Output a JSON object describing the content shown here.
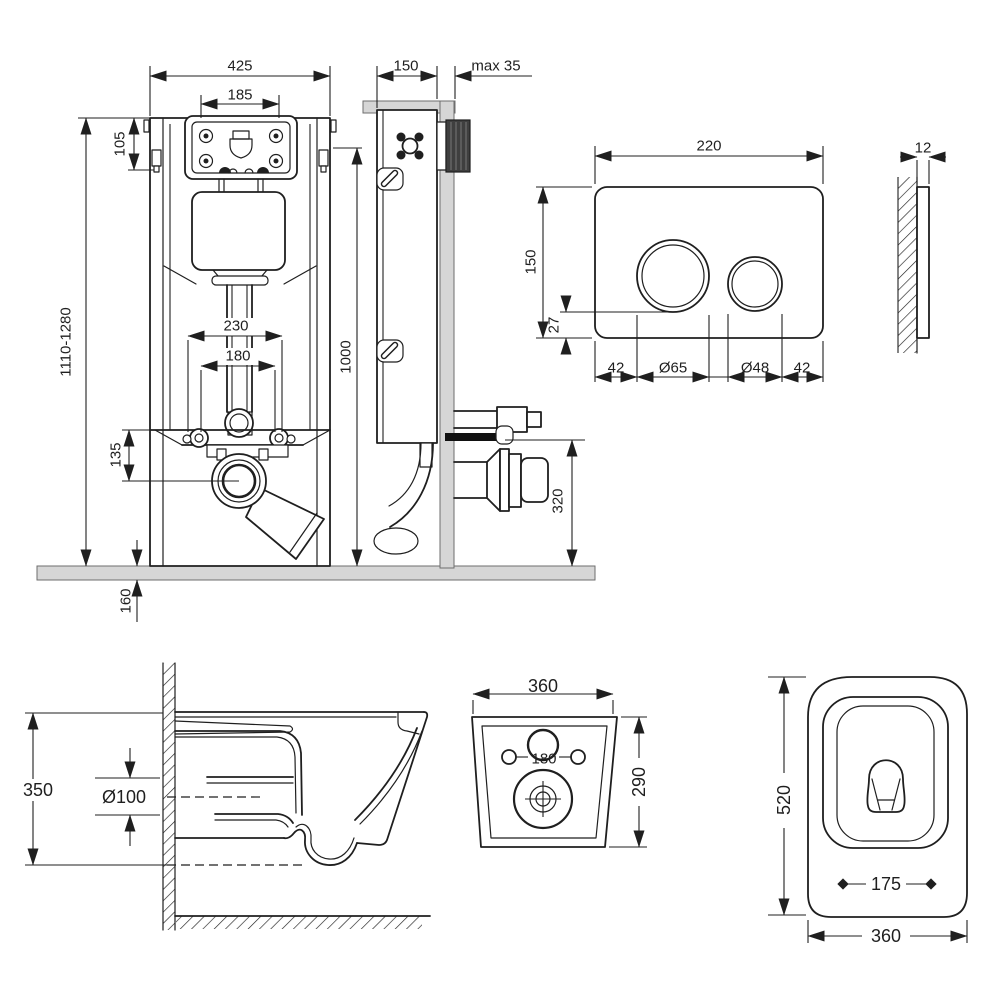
{
  "colors": {
    "line": "#1f1f1f",
    "fill_gray": "#d6d6d6",
    "fill_dark": "#3f3f3f",
    "rear_spacing_label": "#4a281c",
    "background": "#ffffff"
  },
  "diagrams": {
    "frame_front": {
      "width": "425",
      "opening_width": "185",
      "opening_height": "105",
      "height_range": "1110-1280",
      "bend_width": "230",
      "bend_inner_width": "180",
      "outlet_drop": "135",
      "floor_depth": "160"
    },
    "frame_side": {
      "depth": "150",
      "wall_max": "max 35",
      "height": "1000",
      "outlet_height": "320"
    },
    "plate_front": {
      "width": "220",
      "height": "150",
      "bottom_gap": "27",
      "margin_left": "42",
      "big_dia": "Ø65",
      "small_dia": "Ø48",
      "margin_right": "42"
    },
    "plate_side": {
      "thickness": "12"
    },
    "bowl_side": {
      "height": "350",
      "drain_dia": "Ø100"
    },
    "bowl_rear": {
      "width": "360",
      "hole_spacing": "180",
      "height": "290"
    },
    "bowl_top": {
      "length": "520",
      "seat_hole_spacing": "175",
      "width": "360"
    }
  }
}
